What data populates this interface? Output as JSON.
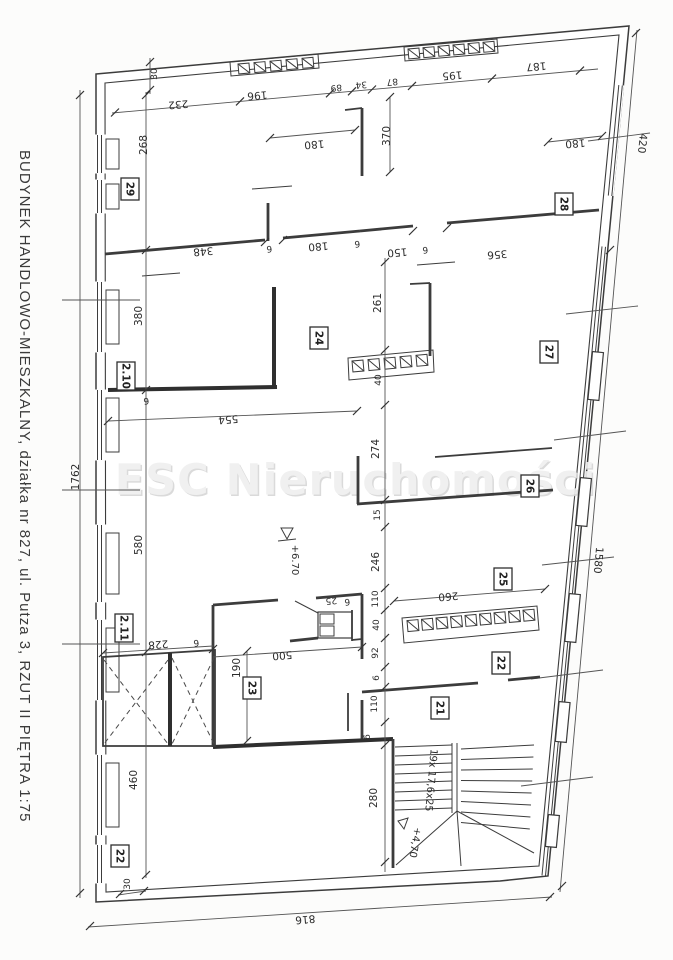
{
  "document": {
    "side_caption": "BUDYNEK HANDLOWO-MIESZKALNY, działka nr 827, ul. Putza 3,   RZUT II PIĘTRA  1:75",
    "watermark": "ESC Nieruchomości"
  },
  "plan": {
    "rooms": [
      "29",
      "28",
      "2.10",
      "24",
      "27",
      "26",
      "25",
      "2.11",
      "23",
      "22",
      "21",
      "22"
    ],
    "levels": {
      "floor": "+6.70",
      "stair_landing": "+4,70"
    },
    "stairs_note": "19x 17,6x25",
    "dims": {
      "top": [
        "232",
        "196",
        "89",
        "34",
        "87",
        "195",
        "187"
      ],
      "upper_rooms": [
        "268",
        "180",
        "370",
        "180"
      ],
      "mid_wall": [
        "348",
        "6",
        "180",
        "6",
        "150",
        "6",
        "356"
      ],
      "left_inner": [
        "380",
        "580",
        "460"
      ],
      "center": [
        "261",
        "40",
        "274",
        "15",
        "246",
        "110",
        "40",
        "92",
        "6",
        "110",
        "6",
        "280"
      ],
      "lower": [
        "554",
        "6",
        "260",
        "228",
        "6",
        "190",
        "500",
        "25",
        "6"
      ],
      "outer": [
        "1762",
        "816",
        "420",
        "1580",
        "30",
        "30"
      ]
    }
  }
}
